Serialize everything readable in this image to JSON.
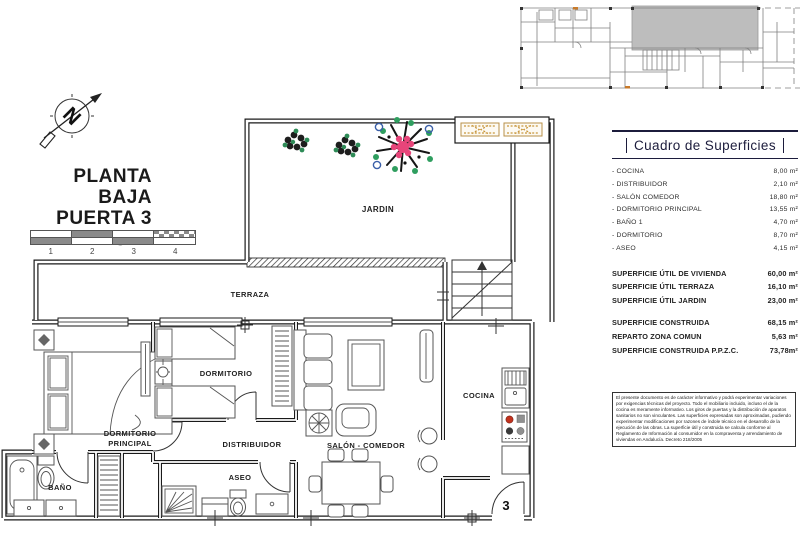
{
  "title_block": {
    "line1": "PLANTA BAJA",
    "line2": "PUERTA 3",
    "scale_caption": "Escala gráfica",
    "scale_ticks": [
      {
        "n": "1"
      },
      {
        "n": "2"
      },
      {
        "n": "3"
      },
      {
        "n": "4"
      }
    ]
  },
  "plan": {
    "labels": {
      "jardin": "JARDIN",
      "terraza": "TERRAZA",
      "dormitorio": "DORMITORIO",
      "dorm_ppal_line1": "DORMITORIO",
      "dorm_ppal_line2": "PRINCIPAL",
      "distribuidor": "DISTRIBUIDOR",
      "bano": "BAÑO",
      "aseo": "ASEO",
      "salon": "SALÓN - COMEDOR",
      "cocina": "COCINA",
      "door_number": "3"
    }
  },
  "surface_table": {
    "title": "Cuadro de Superficies",
    "rooms": [
      {
        "label": "- COCINA",
        "value": "8,00 m²"
      },
      {
        "label": "- DISTRIBUIDOR",
        "value": "2,10 m²"
      },
      {
        "label": "- SALÓN COMEDOR",
        "value": "18,80 m²"
      },
      {
        "label": "- DORMITORIO PRINCIPAL",
        "value": "13,55 m²"
      },
      {
        "label": "- BAÑO 1",
        "value": "4,70 m²"
      },
      {
        "label": "- DORMITORIO",
        "value": "8,70 m²"
      },
      {
        "label": "- ASEO",
        "value": "4,15 m²"
      }
    ],
    "totals_utiles": [
      {
        "label": "SUPERFICIE ÚTIL DE VIVIENDA",
        "value": "60,00 m²"
      },
      {
        "label": "SUPERFICIE ÚTIL TERRAZA",
        "value": "16,10 m²"
      },
      {
        "label": "SUPERFICIE ÚTIL JARDIN",
        "value": "23,00 m²"
      }
    ],
    "totals_construida": [
      {
        "label": "SUPERFICIE CONSTRUIDA",
        "value": "68,15 m²"
      },
      {
        "label": "REPARTO ZONA COMUN",
        "value": "5,63 m²"
      },
      {
        "label": "SUPERFICIE CONSTRUIDA P.P.Z.C.",
        "value": "73,78m²"
      }
    ]
  },
  "disclaimer": "El presente documento es de carácter informativo y podrá experimentar variaciones por exigencias técnicas del proyecto. Todo el mobiliario incluido, incluso el de la cocina es meramente informativo. Los giros de puertas y la distribución de aparatos sanitarios no son vinculantes. Las superficies expresadas son aproximadas, pudiendo experimentar modificaciones por razones de índole técnico en el desarrollo de la ejecución de las obras. La superficie útil y construida se calcula conforme al Reglamento de Información al consumidor en la compraventa y arrendamiento de viviendas en Andalucía. Decreto 218/2005",
  "colors": {
    "accent_navy": "#1c1c3c",
    "plan_line": "#1a1a1a",
    "vent_orange": "#c8963c",
    "plant_pink": "#e8457a",
    "plant_green": "#2e8b57",
    "plant_blue": "#3a5fa8",
    "burner_red": "#c2321e",
    "keyplan_gray": "#bdbdbd"
  }
}
